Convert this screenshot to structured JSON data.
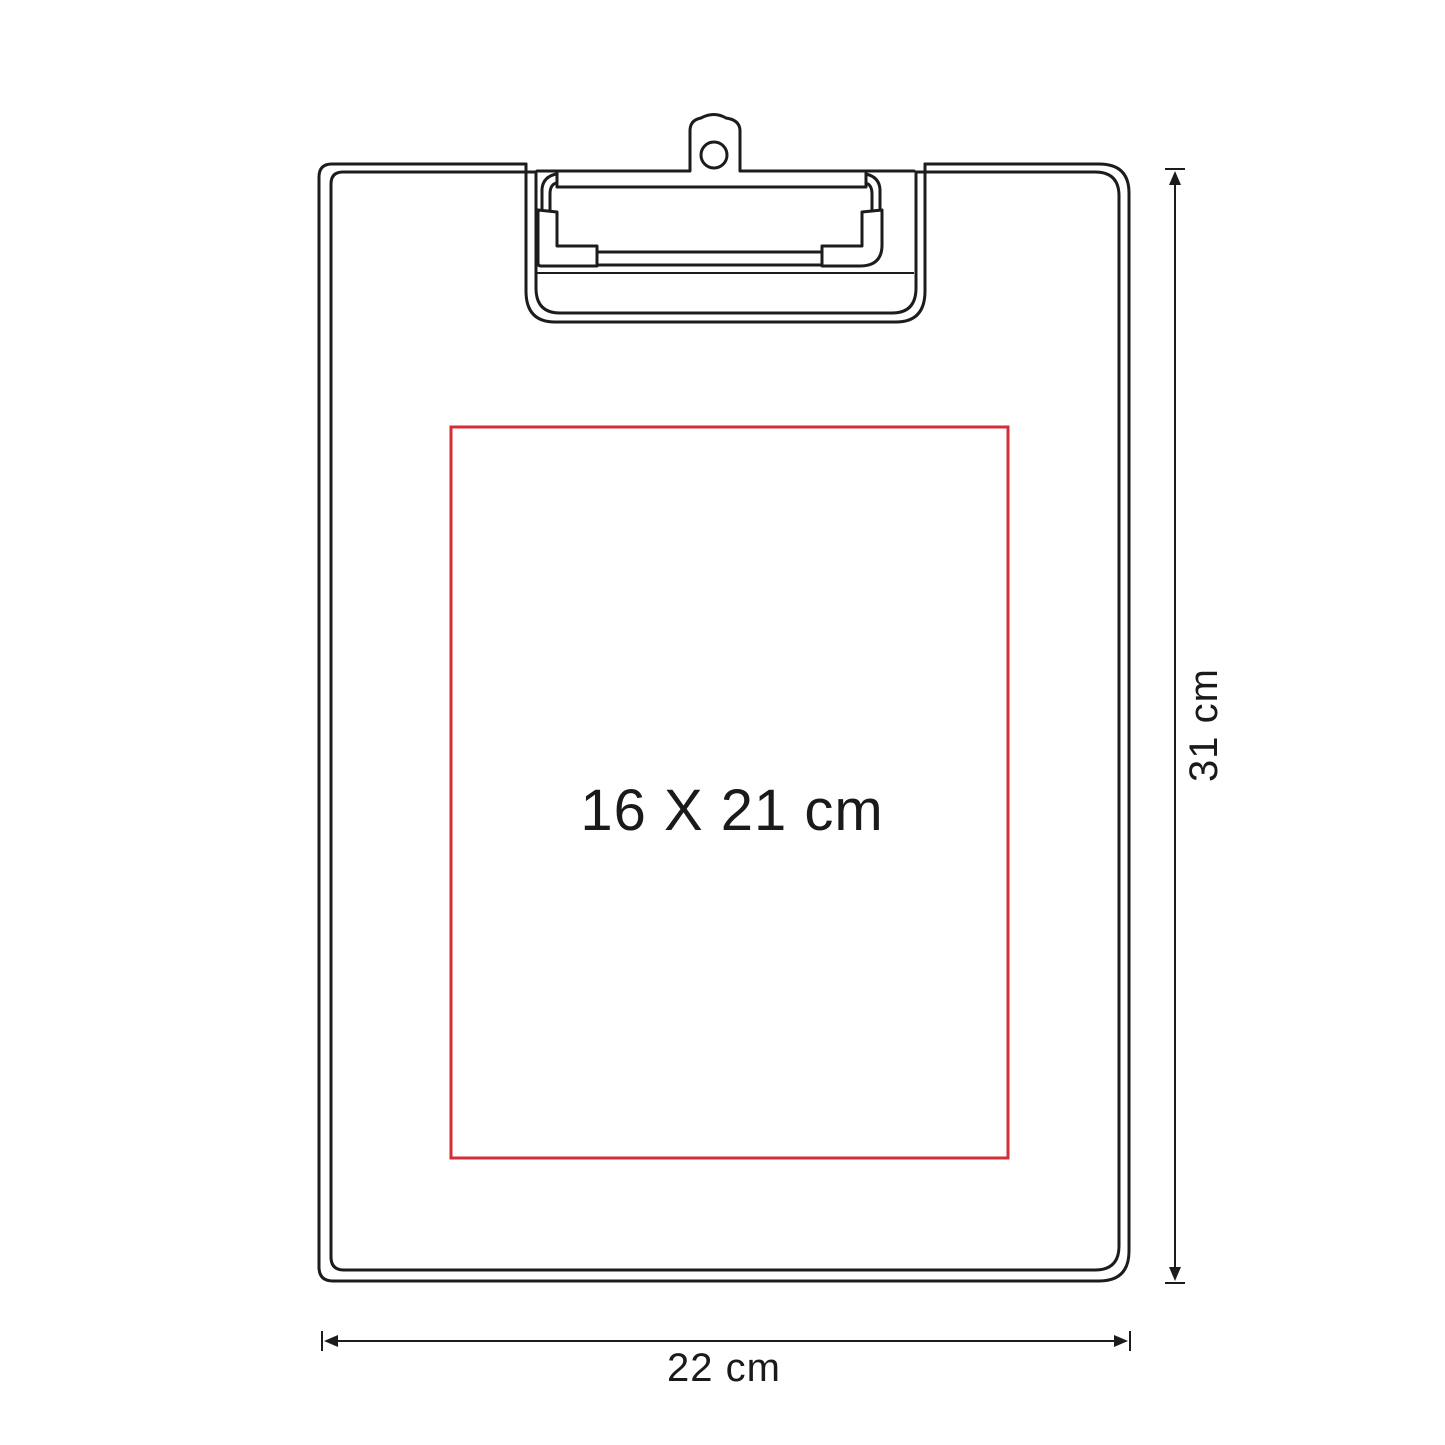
{
  "diagram": {
    "labels": {
      "print_area": "16 X 21 cm",
      "height": "31 cm",
      "width": "22 cm"
    },
    "colors": {
      "outline": "#1c1c1c",
      "print_area": "#d23039",
      "background": "#ffffff"
    }
  }
}
